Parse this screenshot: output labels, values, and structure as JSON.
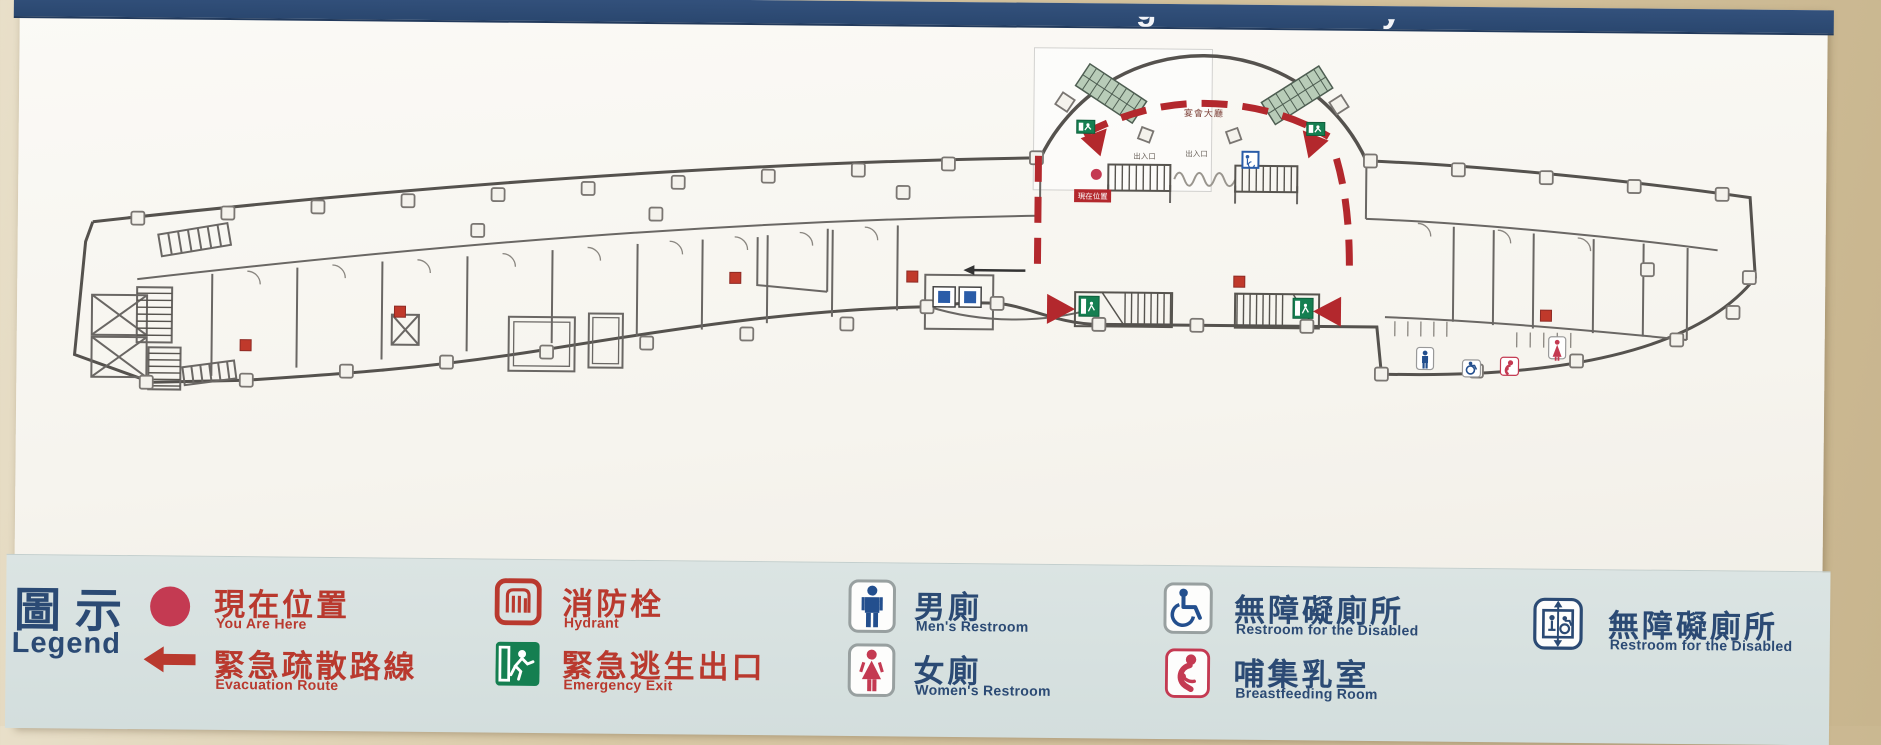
{
  "header": {
    "bar_color": "#2a476f",
    "visible_text_fragments": [
      "g",
      "y"
    ]
  },
  "legend": {
    "title_zh": "圖示",
    "title_en": "Legend",
    "items": [
      {
        "id": "you-are-here",
        "icon": "red-dot-icon",
        "zh": "現在位置",
        "en": "You Are Here"
      },
      {
        "id": "evacuation-route",
        "icon": "red-left-arrow-icon",
        "zh": "緊急疏散路線",
        "en": "Evacuation Route"
      },
      {
        "id": "hydrant",
        "icon": "hydrant-icon",
        "zh": "消防栓",
        "en": "Hydrant"
      },
      {
        "id": "emergency-exit",
        "icon": "running-man-exit-icon",
        "zh": "緊急逃生出口",
        "en": "Emergency Exit"
      },
      {
        "id": "mens-restroom",
        "icon": "man-icon",
        "zh": "男廁",
        "en": "Men's Restroom"
      },
      {
        "id": "womens-restroom",
        "icon": "woman-icon",
        "zh": "女廁",
        "en": "Women's Restroom"
      },
      {
        "id": "accessible-restroom",
        "icon": "wheelchair-icon",
        "zh": "無障礙廁所",
        "en": "Restroom for the Disabled"
      },
      {
        "id": "breastfeeding-room",
        "icon": "mother-baby-icon",
        "zh": "哺集乳室",
        "en": "Breastfeeding Room"
      },
      {
        "id": "accessible-elevator",
        "icon": "accessible-elevator-icon",
        "zh": "無障礙廁所",
        "en": "Restroom for the Disabled"
      }
    ]
  },
  "plan": {
    "labels": {
      "hall": "宴會大廳",
      "entrance_left": "出入口",
      "entrance_center": "出入口",
      "you_are_here_tag": "現在位置"
    }
  },
  "colors": {
    "legend_red": "#b9392e",
    "legend_navy": "#2b4a74",
    "route_red": "#b3282d",
    "exit_green": "#157f51",
    "marker_crimson": "#c43a52",
    "band": "#d7e1e0"
  }
}
